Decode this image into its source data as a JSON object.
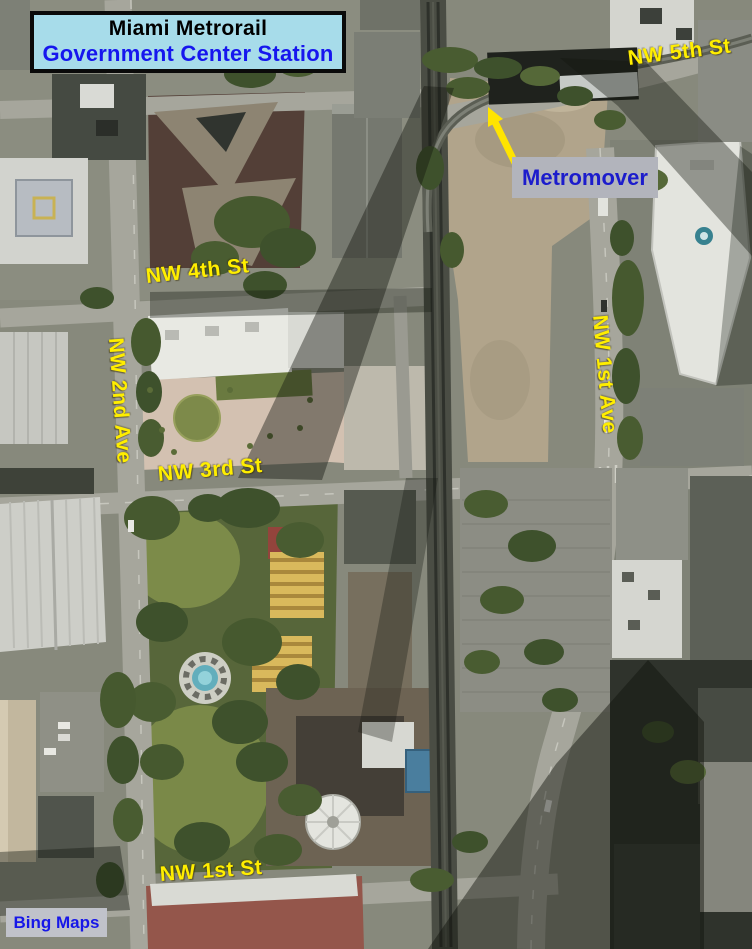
{
  "map": {
    "title_card": {
      "line1": "Miami Metrorail",
      "line2": "Government Center Station"
    },
    "street_labels": {
      "nw_5th_st": "NW 5th St",
      "nw_4th_st": "NW 4th St",
      "nw_2nd_ave": "NW 2nd Ave",
      "nw_3rd_st": "NW 3rd St",
      "nw_1st_ave": "NW 1st Ave",
      "nw_1st_st": "NW 1st St"
    },
    "callout": {
      "metromover": "Metromover"
    },
    "attribution": {
      "provider": "Bing Maps"
    }
  },
  "colors": {
    "street_label": "#ffee00",
    "title_bg": "#a7dcea",
    "title_text": "#000000",
    "title_accent": "#1616ee",
    "callout_bg": "#b2b4bc",
    "callout_text": "#1c1ccc",
    "attribution_bg": "#c0c2ca",
    "attribution_text": "#1717e8",
    "arrow": "#ffe400"
  }
}
